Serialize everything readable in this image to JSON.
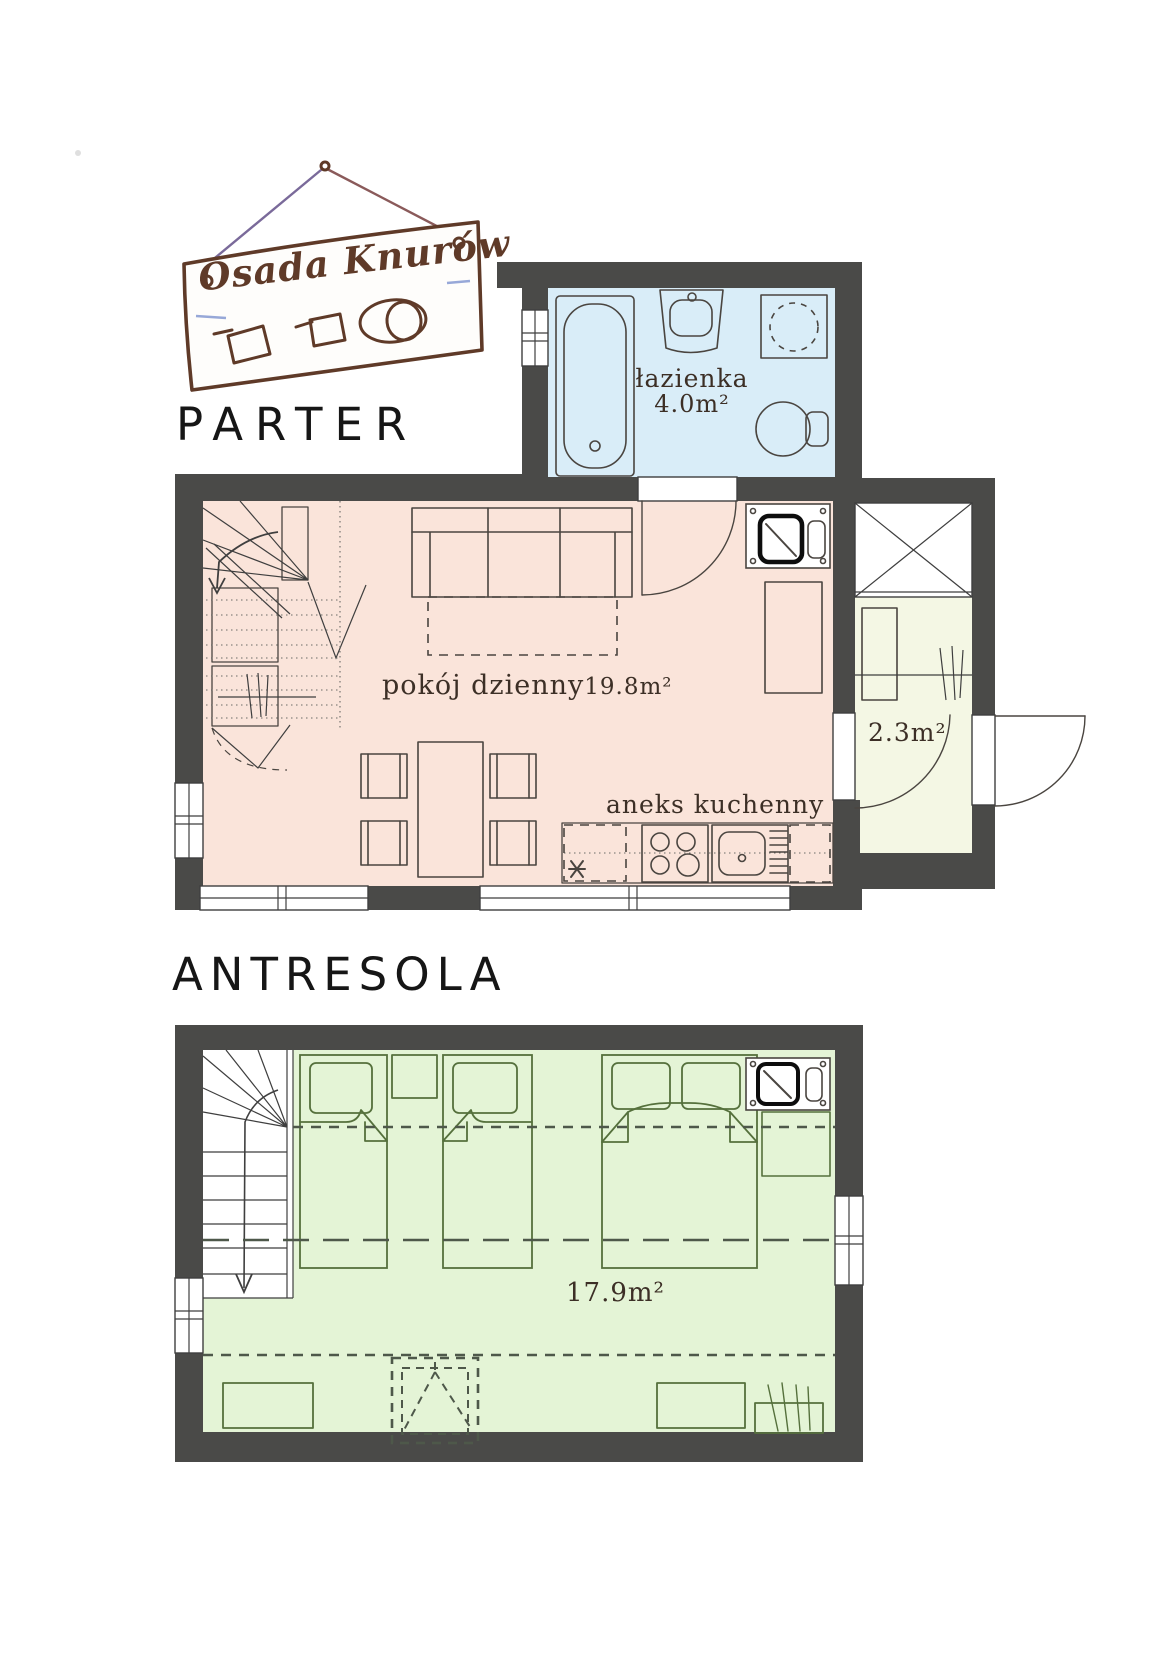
{
  "logo": {
    "text": "Osada Knurów"
  },
  "parter": {
    "title": "PARTER",
    "bathroom": {
      "name": "łazienka",
      "area": "4.0m²"
    },
    "living": {
      "name": "pokój dzienny",
      "area": "19.8m²"
    },
    "kitchen": {
      "name": "aneks kuchenny"
    },
    "hall": {
      "area": "2.3m²"
    }
  },
  "antresola": {
    "title": "ANTRESOLA",
    "bedroom": {
      "area": "17.9m²"
    }
  },
  "colors": {
    "wall": "#4a4a48",
    "bathroom_floor": "#d9edf8",
    "living_floor": "#fae4da",
    "hall_floor": "#f4f7e4",
    "bedroom_floor": "#e4f4d6",
    "line": "#4a4540",
    "bed_line": "#55703c",
    "dash": "#4e584a",
    "logo_ink": "#5f3a28",
    "title": "#161616",
    "label": "#3c2f26"
  }
}
